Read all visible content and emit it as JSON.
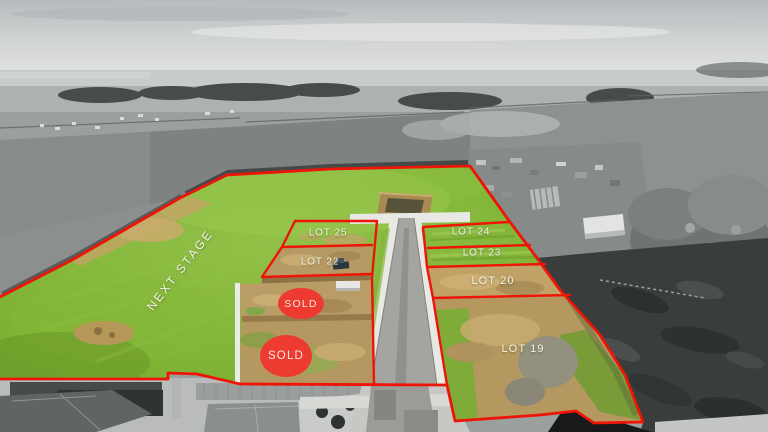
{
  "annotations": {
    "next_stage_label": "NEXT STAGE",
    "lots": [
      {
        "id": "lot-25",
        "label": "LOT 25"
      },
      {
        "id": "lot-22",
        "label": "LOT 22"
      },
      {
        "id": "lot-24",
        "label": "LOT 24"
      },
      {
        "id": "lot-23",
        "label": "LOT 23"
      },
      {
        "id": "lot-20",
        "label": "LOT 20"
      },
      {
        "id": "lot-19",
        "label": "LOT 19"
      }
    ],
    "sold_badges": [
      {
        "label": "SOLD"
      },
      {
        "label": "SOLD"
      }
    ]
  },
  "colors": {
    "lot_outline_red": "#ee1408",
    "sold_badge_red": "#ee3b31",
    "label_white": "#f2f4ec",
    "stage_grass_green": "#7cb133",
    "earthworks_tan": "#b9985f"
  }
}
